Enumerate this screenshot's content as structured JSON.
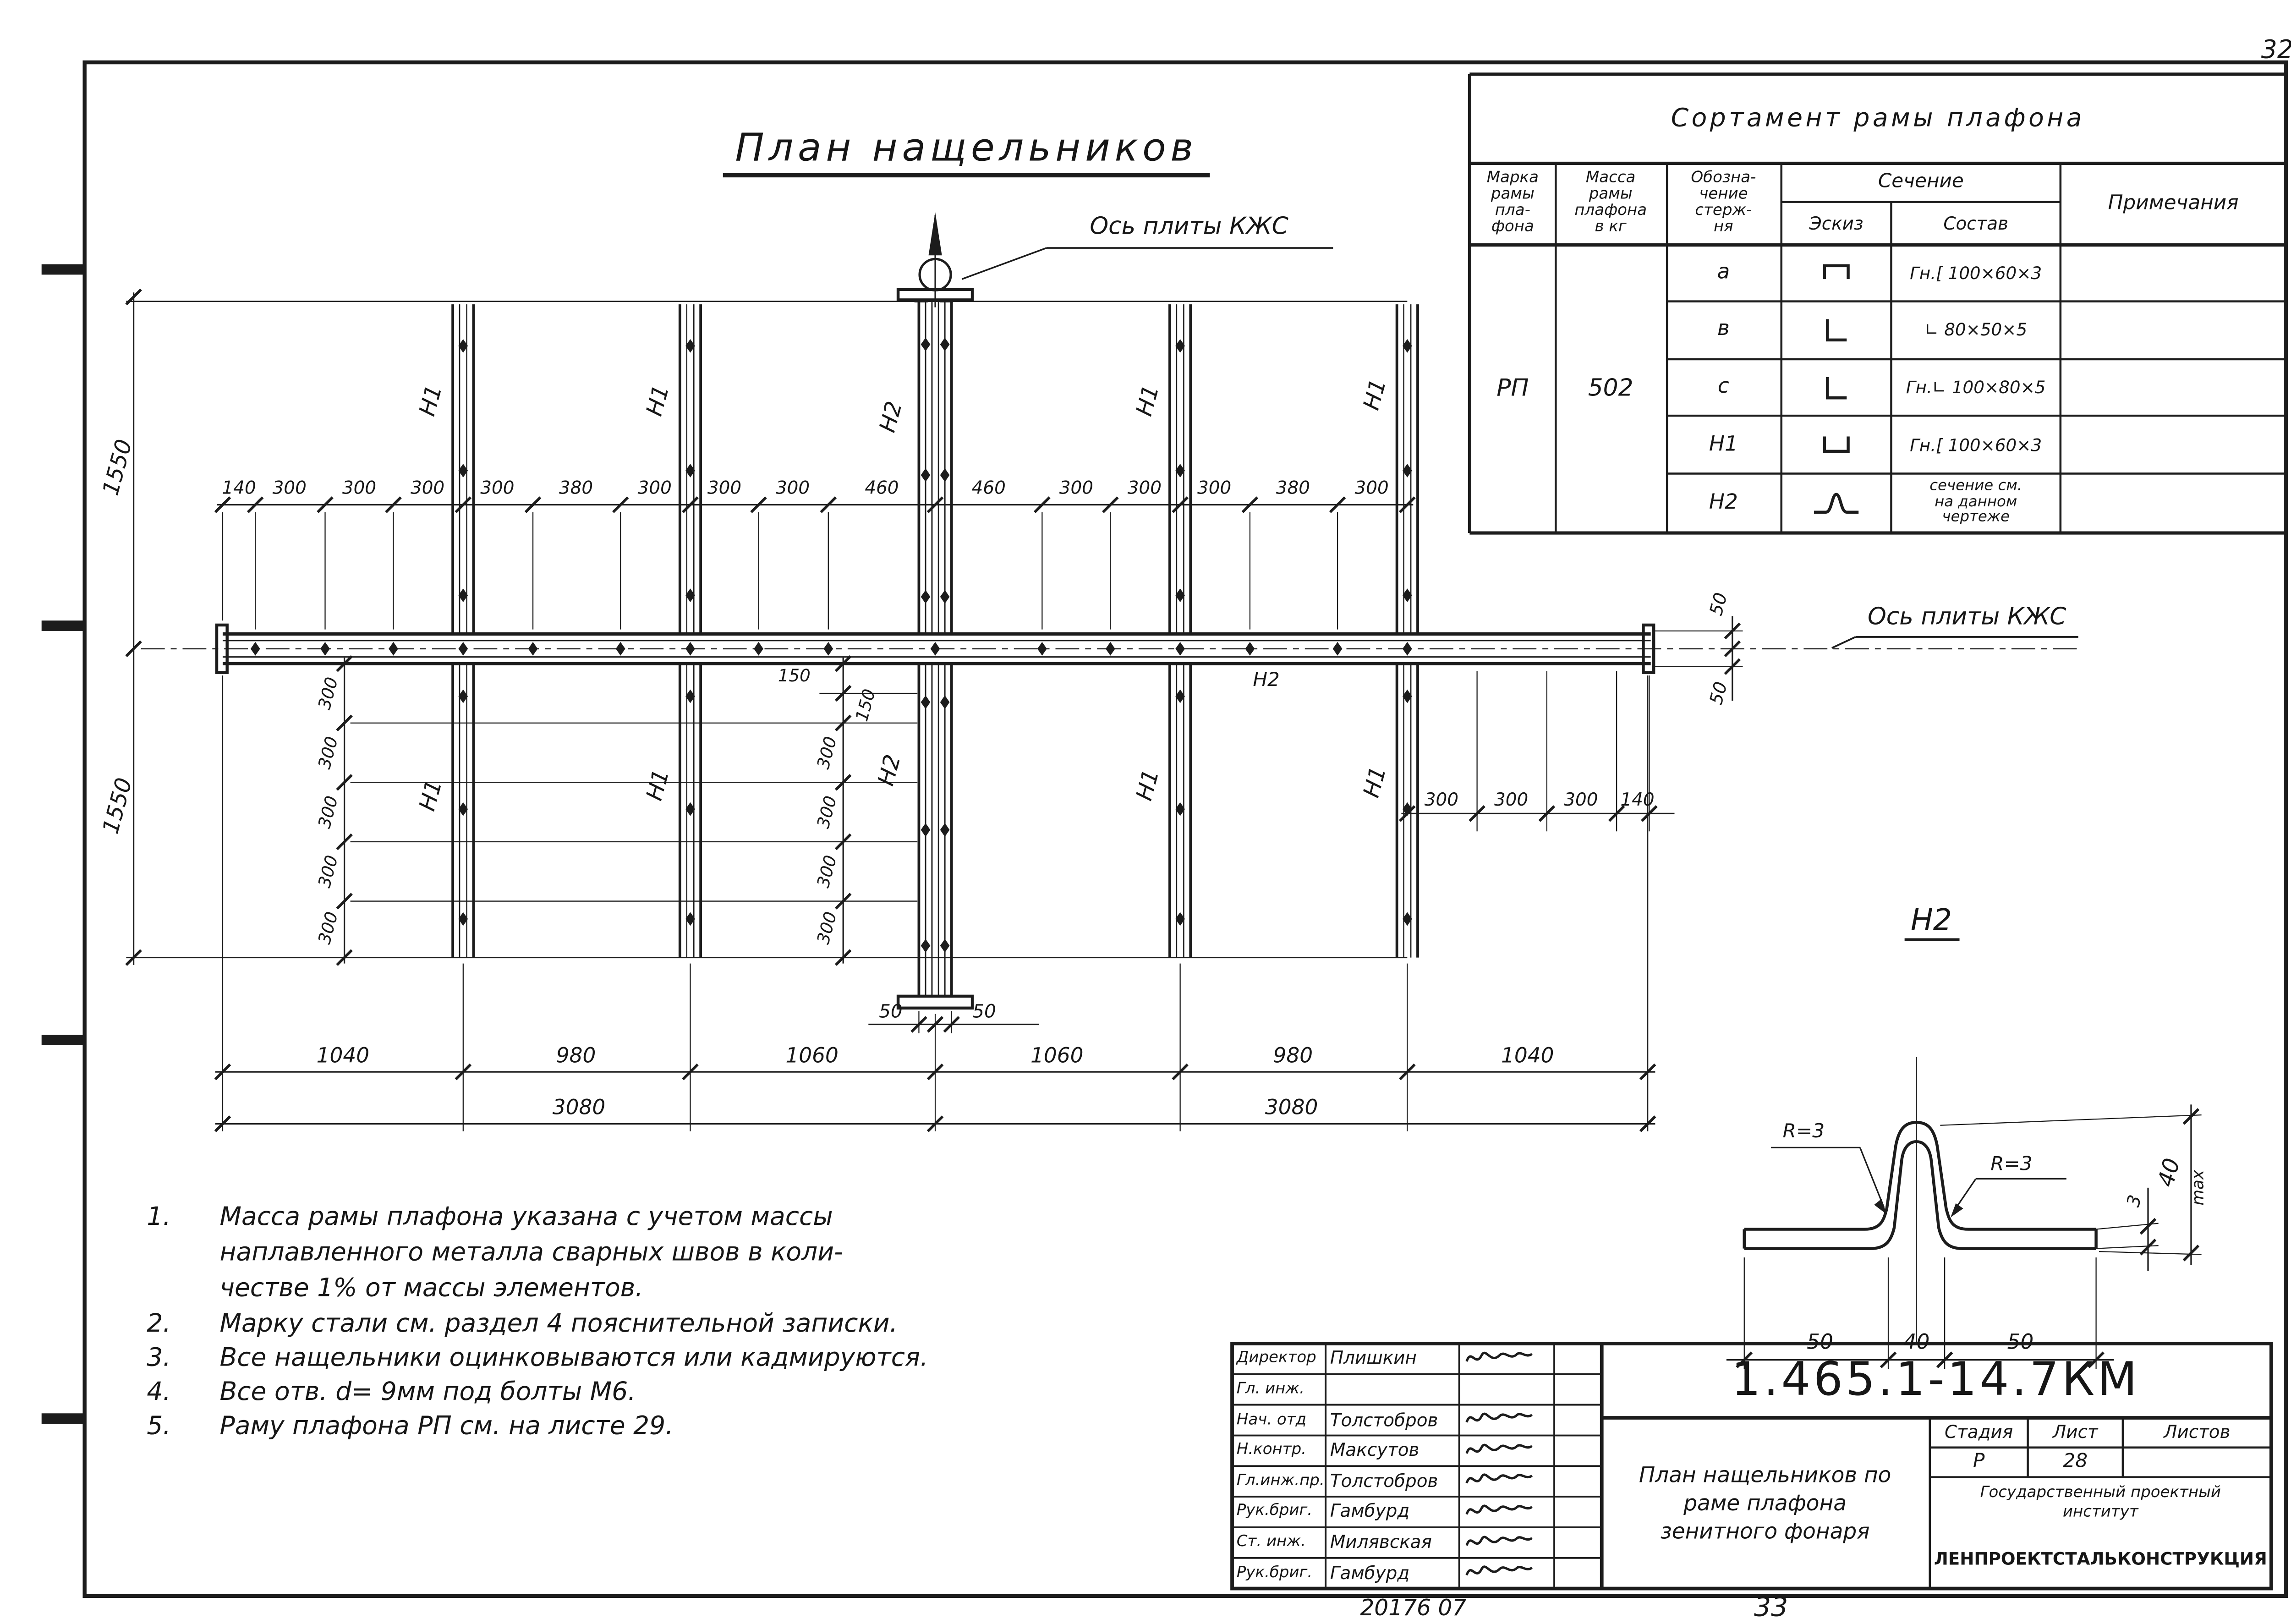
{
  "sheet": {
    "corner_number": "32",
    "stamp_code": "20176 07",
    "page_number": "33"
  },
  "plan": {
    "title": "План  нащельников",
    "axis_label_top": "Ось плиты КЖС",
    "axis_label_right": "Ось плиты КЖС",
    "beam_label": "Н2",
    "strip_labels_top": [
      "Н1",
      "Н1",
      "Н2",
      "Н1",
      "Н1"
    ],
    "strip_labels_bottom": [
      "Н1",
      "Н1",
      "Н2",
      "Н1",
      "Н1"
    ],
    "dims": {
      "top_chain": [
        "140",
        "300",
        "300",
        "300",
        "300",
        "380",
        "300",
        "300",
        "300",
        "460",
        "460",
        "300",
        "300",
        "300",
        "380",
        "300"
      ],
      "left_upper": "1550",
      "left_lower": "1550",
      "left_chain": [
        "300",
        "300",
        "300",
        "300",
        "300"
      ],
      "center_chain": [
        "150",
        "150",
        "300",
        "300",
        "300",
        "300"
      ],
      "right_chain": [
        "300",
        "300",
        "300",
        "140"
      ],
      "beam_end_upper": "50",
      "beam_end_lower": "50",
      "center_bottom_left": "50",
      "center_bottom_right": "50",
      "spans": [
        "1040",
        "980",
        "1060",
        "1060",
        "980",
        "1040"
      ],
      "totals": [
        "3080",
        "3080"
      ]
    }
  },
  "sortament": {
    "title": "Сортамент  рамы  плафона",
    "headers": {
      "marka": "Марка\nрамы\nпла-\nфона",
      "massa": "Масса\nрамы\nплафона\nв кг",
      "oboznachenie": "Обозна-\nчение\nстерж-\nня",
      "sechenie": "Сечение",
      "eskiz": "Эскиз",
      "sostav": "Состав",
      "primechaniya": "Примечания"
    },
    "marka_value": "РП",
    "massa_value": "502",
    "rows": [
      {
        "id": "а",
        "sostav": "Гн.[ 100×60×3"
      },
      {
        "id": "в",
        "sostav": "∟ 80×50×5"
      },
      {
        "id": "с",
        "sostav": "Гн.∟ 100×80×5"
      },
      {
        "id": "Н1",
        "sostav": "Гн.[ 100×60×3"
      },
      {
        "id": "Н2",
        "sostav": "сечение см.\nна данном\nчертеже"
      }
    ]
  },
  "detail": {
    "title": "Н2",
    "radius_left": "R=3",
    "radius_right": "R=3",
    "height": "40",
    "height_suffix": "max",
    "thickness": "3",
    "bottom_chain": [
      "50",
      "40",
      "50"
    ]
  },
  "notes": {
    "items": [
      {
        "num": "1.",
        "lines": [
          "Масса рамы плафона указана с учетом  массы",
          "наплавленного металла сварных швов в коли-",
          "честве 1%  от массы элементов."
        ]
      },
      {
        "num": "2.",
        "lines": [
          "Марку стали см. раздел 4 пояснительной  записки."
        ]
      },
      {
        "num": "3.",
        "lines": [
          "Все нащельники  оцинковываются  или кадмируются."
        ]
      },
      {
        "num": "4.",
        "lines": [
          "Все отв. d= 9мм  под болты М6."
        ]
      },
      {
        "num": "5.",
        "lines": [
          "Раму  плафона  РП  см. на листе 29."
        ]
      }
    ]
  },
  "title_block": {
    "doc_number": "1.465.1-14.7КМ",
    "drawing_title_lines": [
      "План нащельников по",
      "раме  плафона",
      "зенитного фонаря"
    ],
    "stage_header": [
      "Стадия",
      "Лист",
      "Листов"
    ],
    "stage": "Р",
    "sheet": "28",
    "sheets": "",
    "institute_line1": "Государственный    проектный",
    "institute_line2": "институт",
    "institute_name": "ЛЕНПРОЕКТСТАЛЬКОНСТРУКЦИЯ",
    "rows": [
      {
        "role": "Директор",
        "name": "Плишкин"
      },
      {
        "role": "Гл. инж.",
        "name": ""
      },
      {
        "role": "Нач. отд",
        "name": "Толстобров"
      },
      {
        "role": "Н.контр.",
        "name": "Максутов"
      },
      {
        "role": "Гл.инж.пр.",
        "name": "Толстобров"
      },
      {
        "role": "Рук.бриг.",
        "name": "Гамбурд"
      },
      {
        "role": "Ст. инж.",
        "name": "Милявская"
      },
      {
        "role": "Рук.бриг.",
        "name": "Гамбурд"
      }
    ]
  }
}
